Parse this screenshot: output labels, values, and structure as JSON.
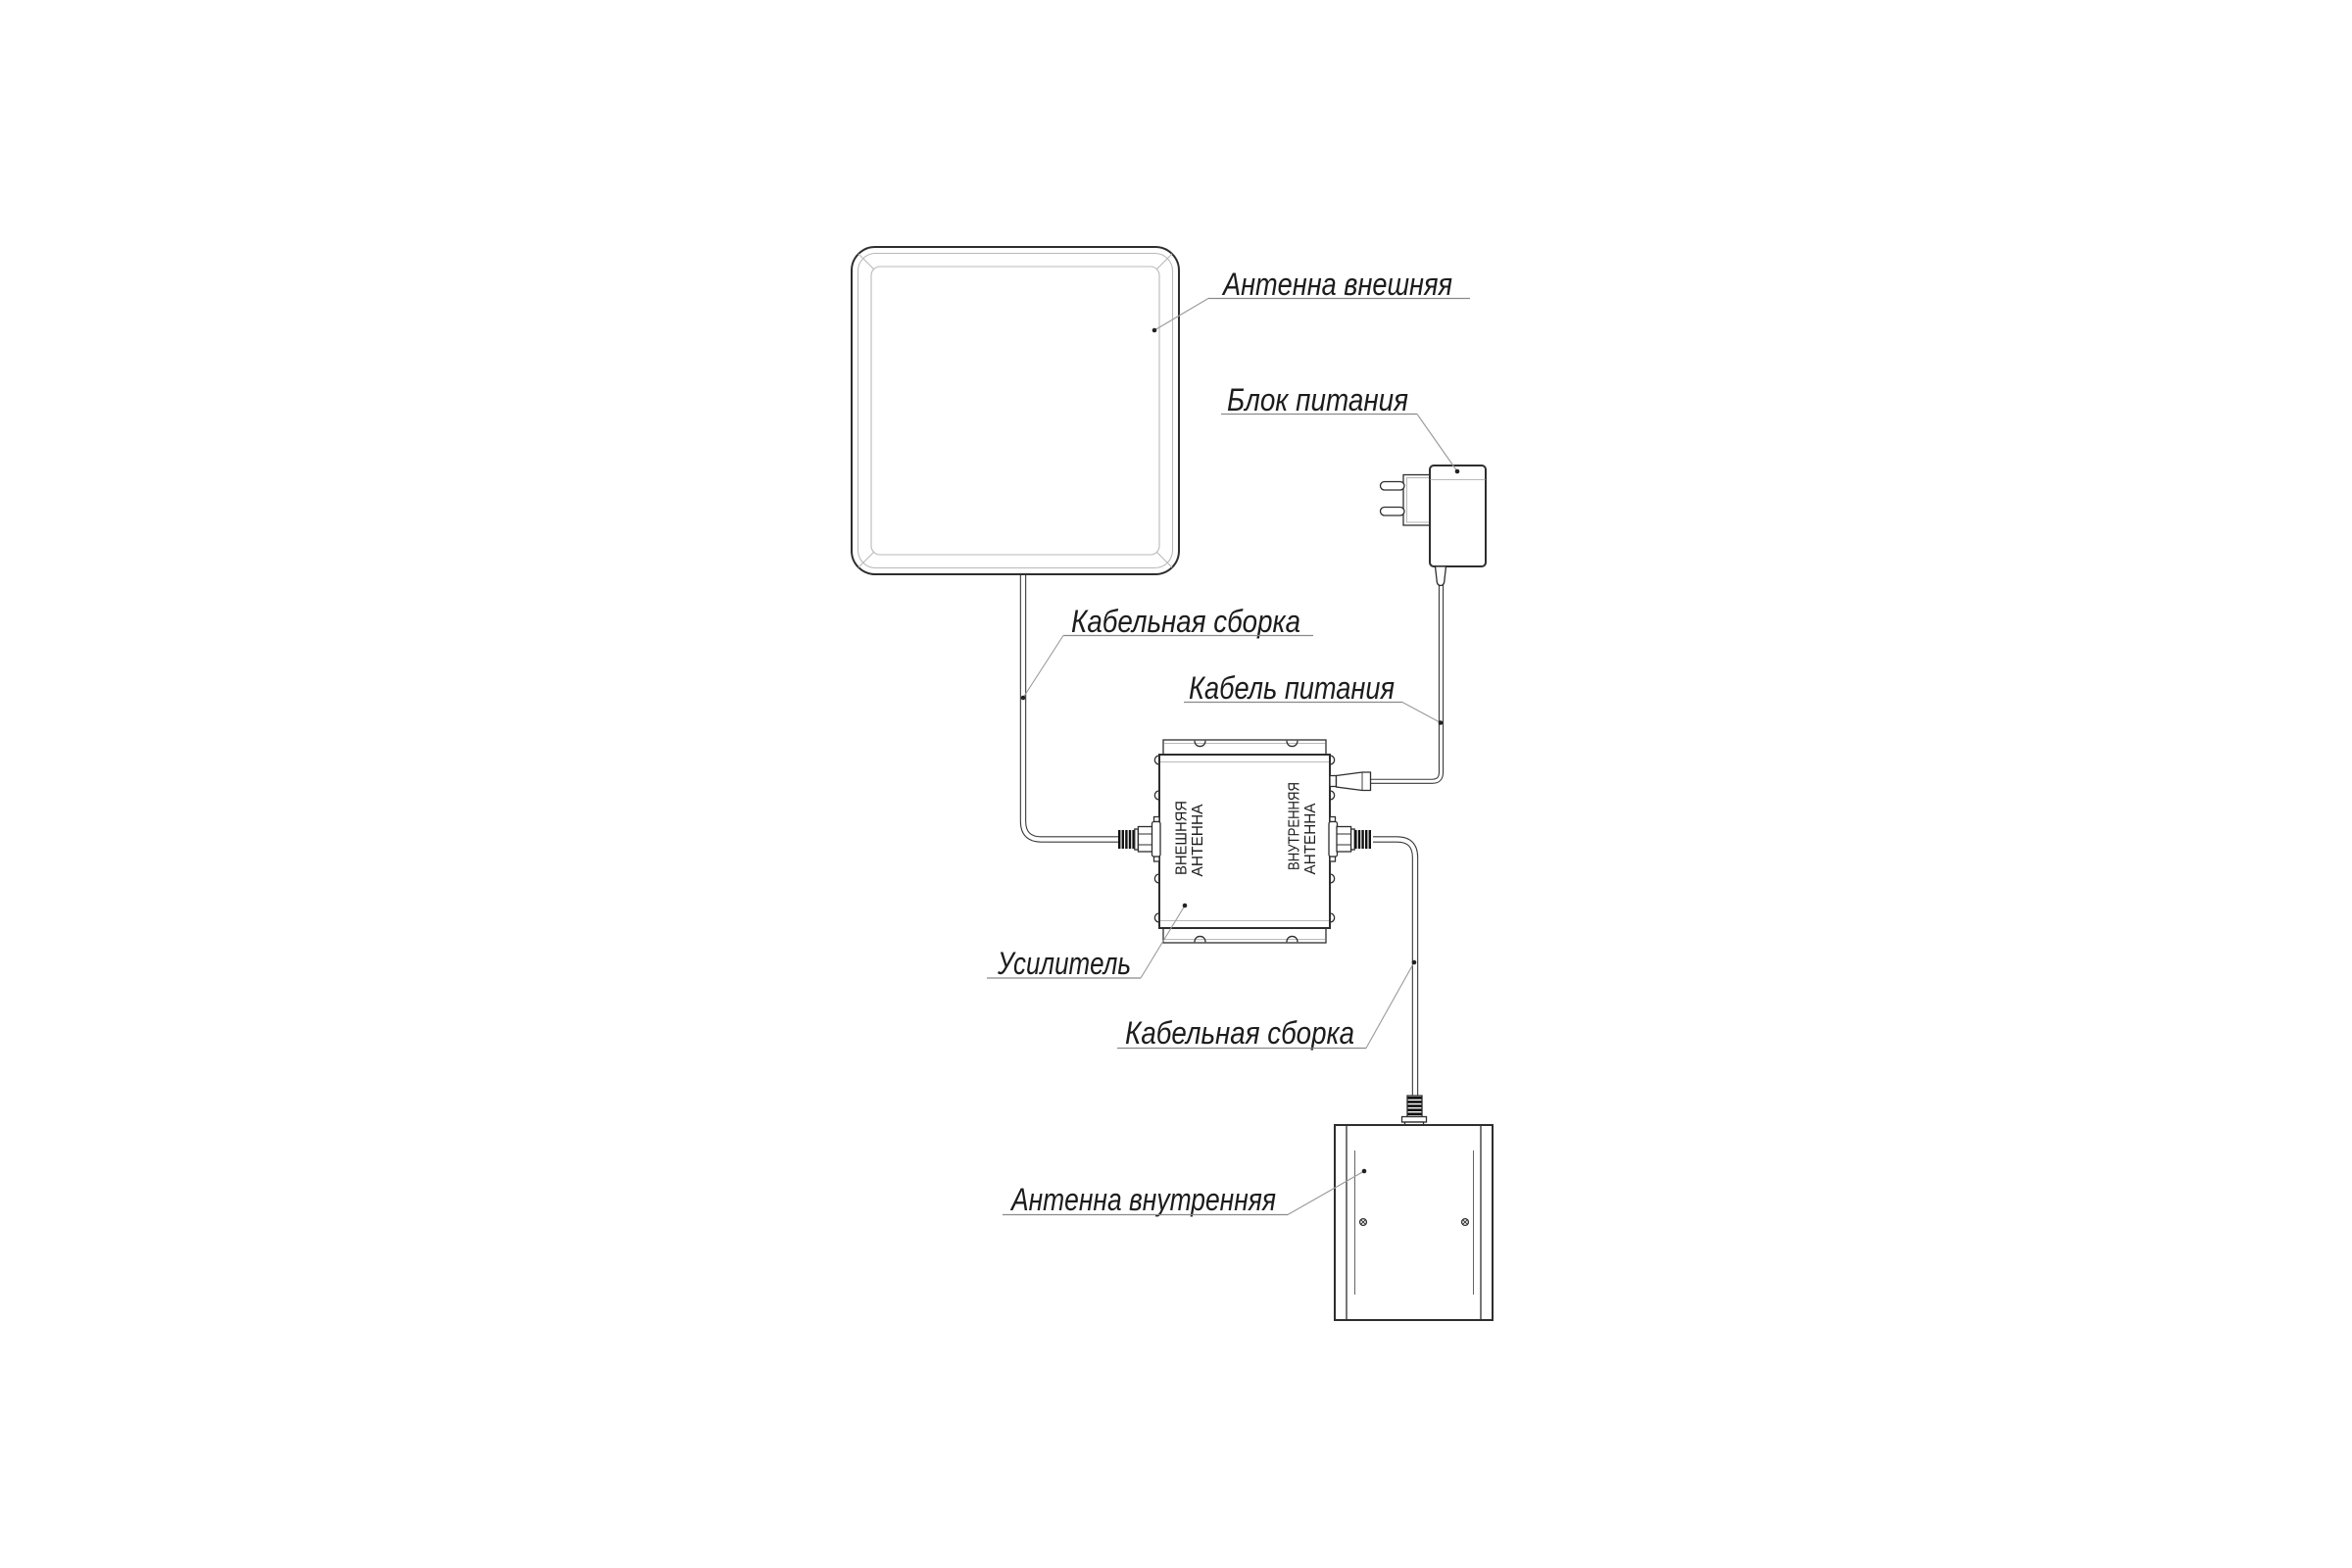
{
  "diagram": {
    "type": "connection-scheme",
    "labels": {
      "outdoor_antenna": "Антенна внешняя",
      "power_supply": "Блок питания",
      "cable_assembly_top": "Кабельная сборка",
      "power_cable": "Кабель питания",
      "amplifier": "Усилитель",
      "cable_assembly_bottom": "Кабельная сборка",
      "indoor_antenna": "Антенна внутренняя"
    },
    "amplifier_ports": {
      "left": {
        "line1": "ВНЕШНЯЯ",
        "line2": "АНТЕННА"
      },
      "right": {
        "line1": "ВНУТРЕННЯЯ",
        "line2": "АНТЕННА"
      }
    },
    "colors": {
      "background": "#ffffff",
      "main_line": "#2e2e2e",
      "light_line": "#b9b9b9",
      "leader_line": "#9a9a9a",
      "text": "#1c1c1c",
      "connector_fill": "#111111"
    }
  }
}
